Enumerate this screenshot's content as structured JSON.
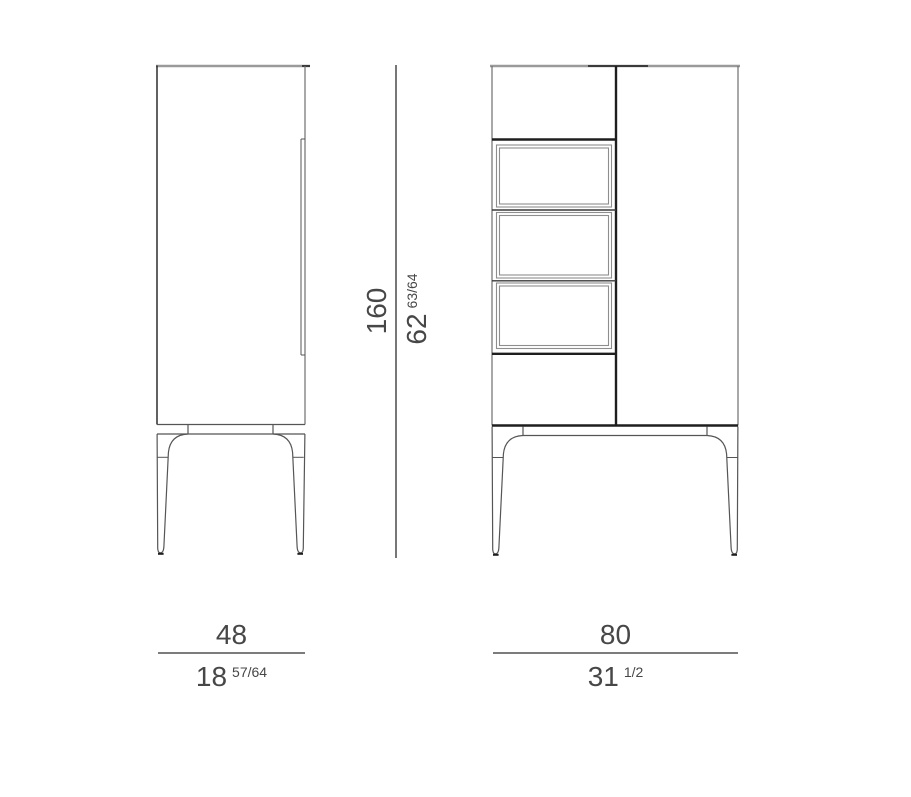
{
  "diagram": {
    "type": "furniture technical drawing",
    "views": [
      {
        "id": "side-view",
        "description": "cabinet side elevation with door handle groove and tapered legs"
      },
      {
        "id": "front-view",
        "description": "cabinet front elevation with left column (top flap, three framed drawers, bottom flap), right tall door and tapered legs"
      }
    ]
  },
  "dimensions": {
    "side_width": {
      "cm": "48",
      "in_whole": "18",
      "in_frac": "57/64"
    },
    "front_width": {
      "cm": "80",
      "in_whole": "31",
      "in_frac": "1/2"
    },
    "height": {
      "cm": "160",
      "in_whole": "62",
      "in_frac": "63/64"
    }
  },
  "colors": {
    "background": "#ffffff",
    "line_light": "#9a9a9a",
    "line_frame": "#8e8e8e",
    "line_medium": "#555555",
    "line_edge": "#6e6e6e",
    "line_middark": "#3a3a3a",
    "line_dark": "#1e1e1e",
    "dim_line": "#2e2e2e",
    "text": "#474747"
  }
}
